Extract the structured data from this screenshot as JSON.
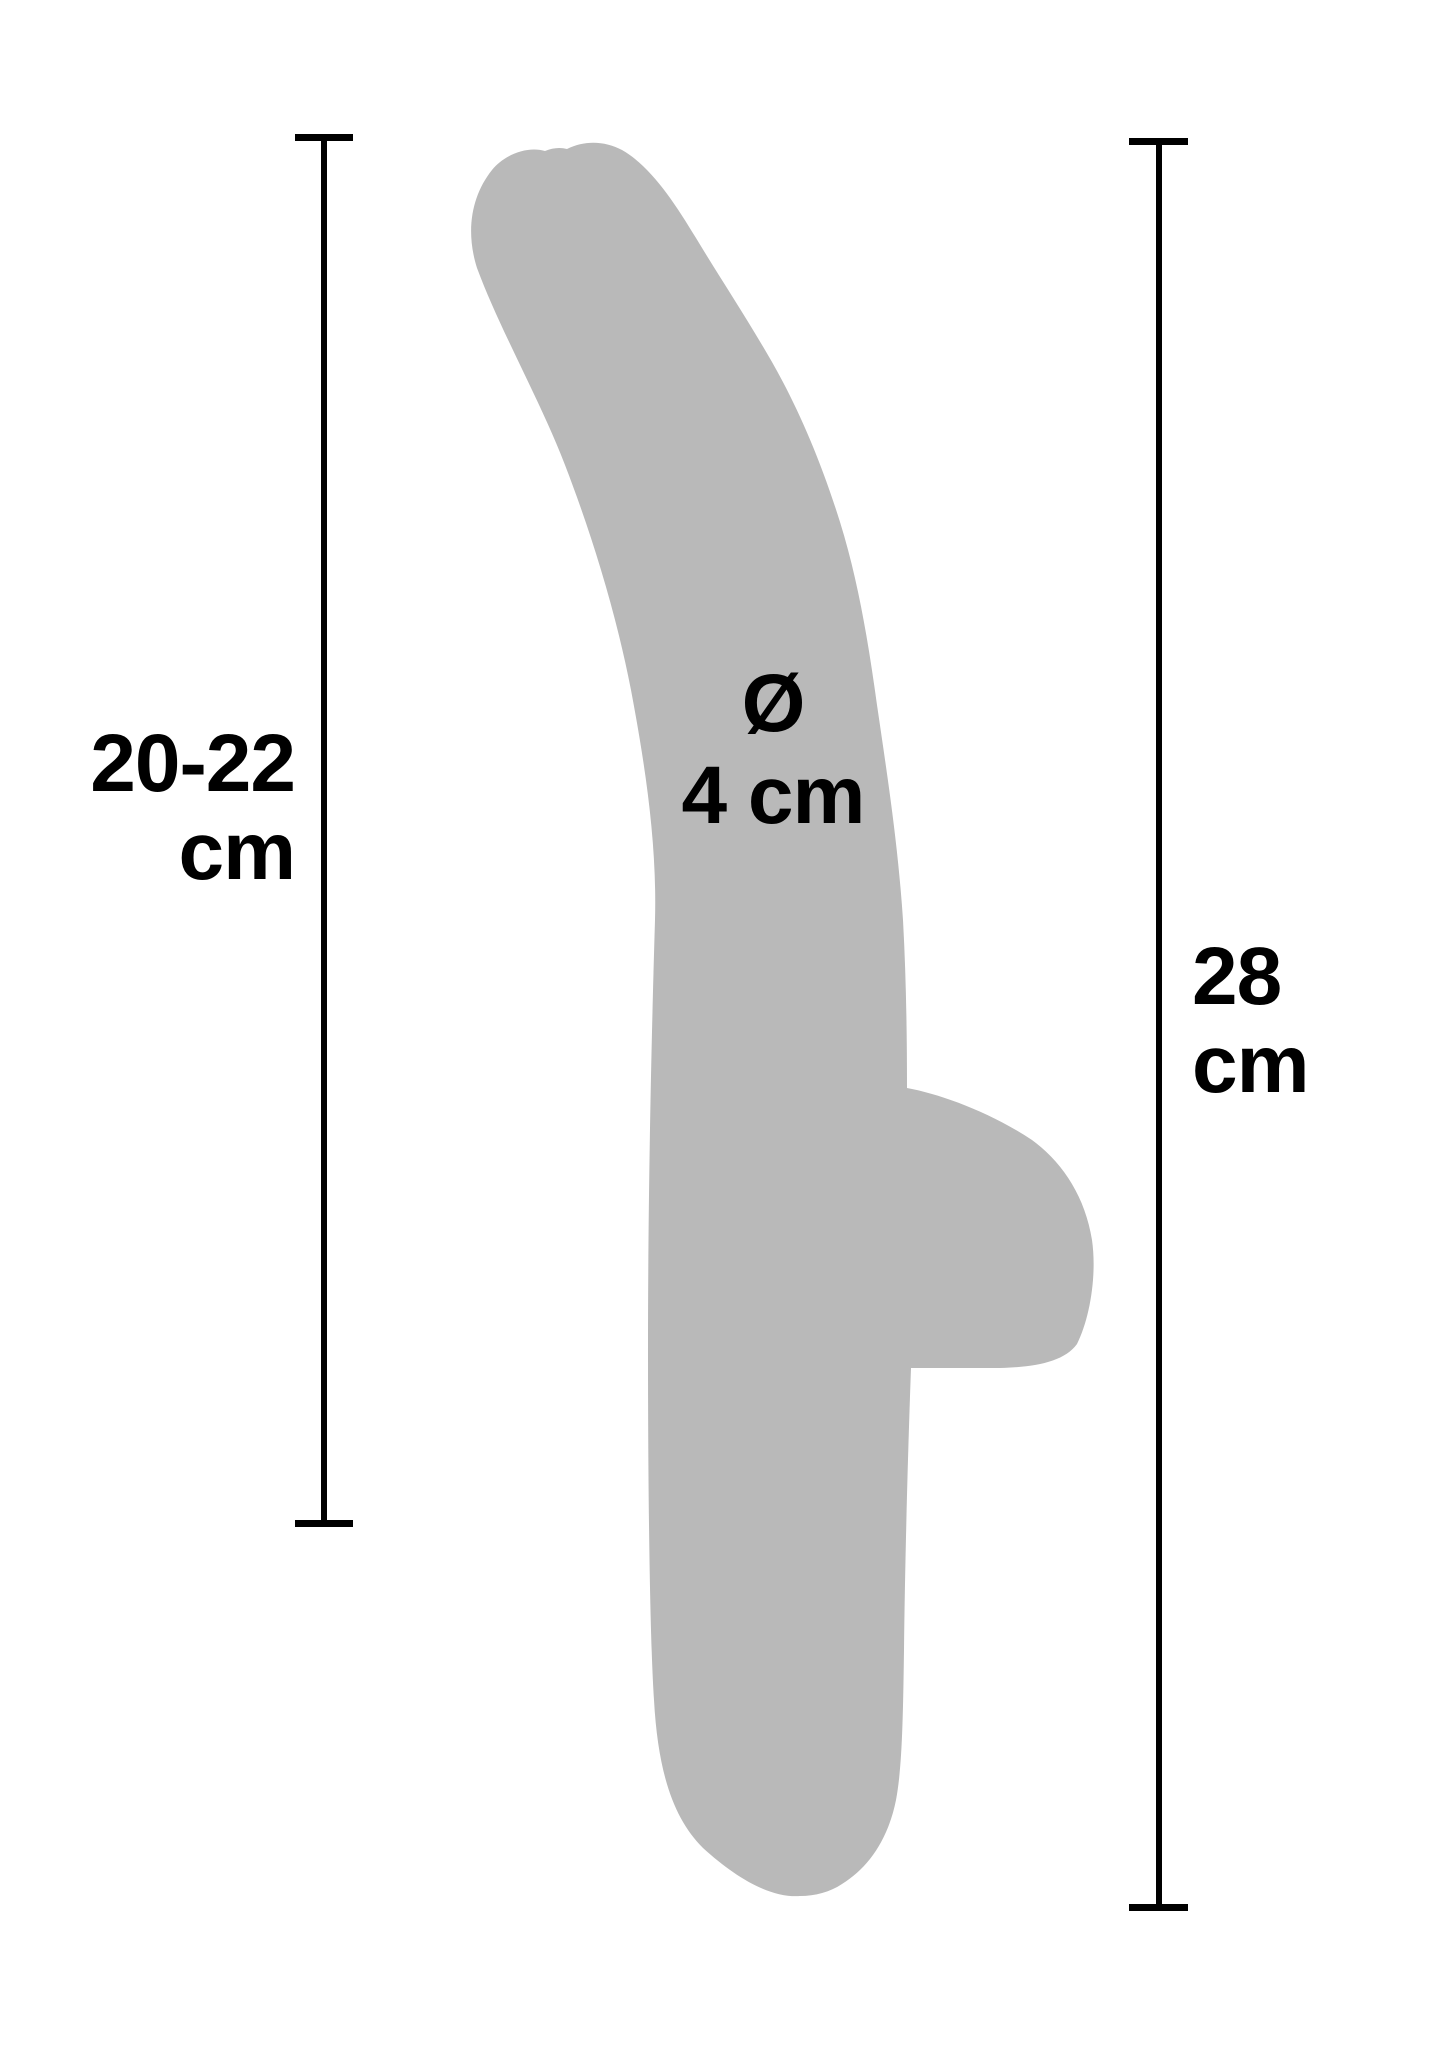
{
  "measurements": {
    "insertable_length": {
      "line1": "20-22",
      "line2": "cm"
    },
    "total_length": {
      "line1": "28",
      "line2": "cm"
    },
    "diameter": {
      "symbol": "Ø",
      "value": "4 cm"
    }
  },
  "silhouette": {
    "description": "gray product silhouette of curved wand with side stimulator arm",
    "path": "M 800 1896 C 770 1898 736 1878 703 1848 C 673 1818 658 1772 654 1700 C 650 1640 648 1500 648 1350 C 648 1180 652 1020 655 920 C 657 845 646 770 631 690 C 615 608 590 530 565 465 C 540 400 500 330 477 268 C 465 230 472 195 492 170 C 505 154 528 146 545 151 C 552 148 560 147 567 149 C 585 140 605 141 622 150 C 650 166 673 200 696 238 C 720 278 745 315 772 362 C 797 406 820 458 840 522 C 858 580 868 640 877 705 C 888 780 898 845 903 920 C 906 975 907 1030 907 1088 C 940 1094 990 1112 1032 1140 C 1062 1162 1085 1196 1092 1240 C 1097 1275 1090 1318 1077 1344 C 1064 1362 1035 1367 1000 1368 L 911 1368 C 908 1450 905 1560 904 1650 C 903 1722 902 1768 896 1800 C 888 1840 868 1868 842 1884 C 830 1892 815 1896 800 1896 Z"
  },
  "colors": {
    "background": "#ffffff",
    "silhouette": "#b9b9b9",
    "dimension-line": "#000000",
    "text": "#000000"
  }
}
